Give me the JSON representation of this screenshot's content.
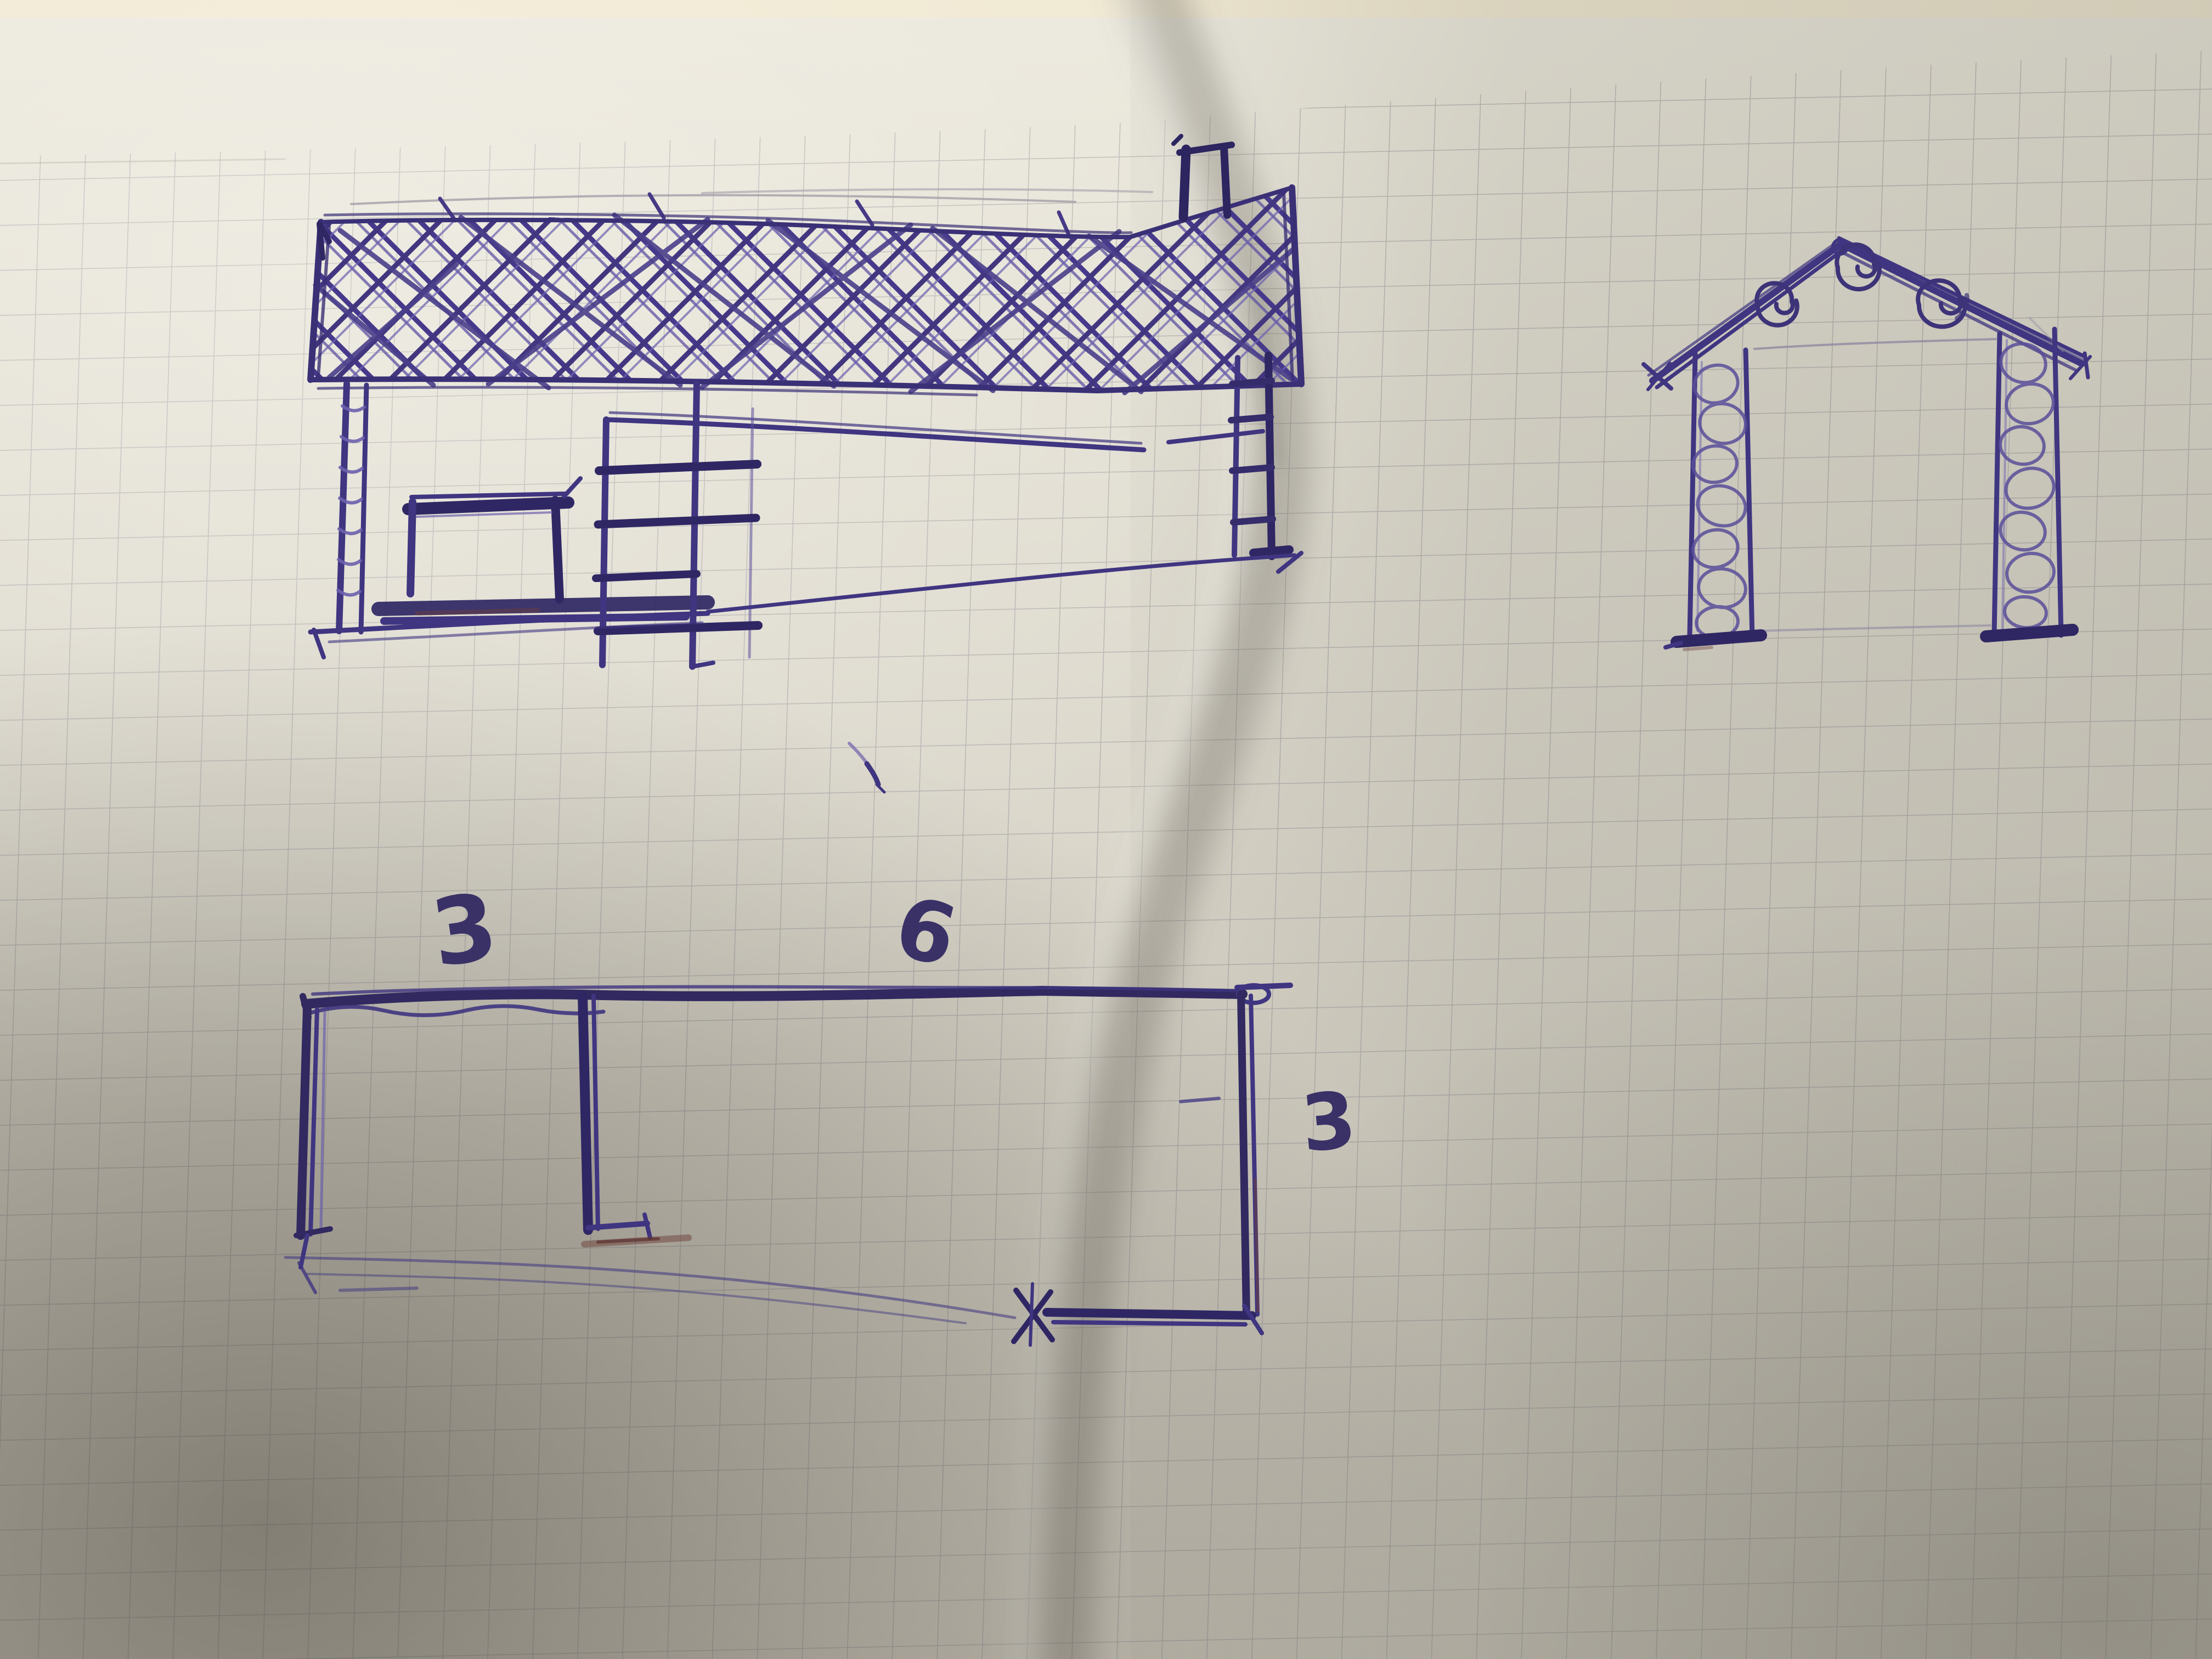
{
  "page": {
    "kind": "photograph of a hand-drawn pen sketch on folded squared (graph) paper",
    "paper": {
      "base_color": "#e7e3d7",
      "grid_color": "#8f8b96",
      "cream_band_color": "#f0e8d1",
      "shadow_color": "#8f8b80"
    },
    "ink": {
      "main": "#3f3580",
      "heavy": "#2f2763",
      "light": "#6c61ad",
      "pencil": "#a19caa",
      "red_accent": "#6e3f39"
    },
    "elements": [
      "house-side-elevation-with-crosshatched-roof-and-chimney",
      "gable-end-view-with-stone-columns-and-spiral-eaves",
      "floor-plan-rectangle-with-dimensions"
    ]
  },
  "floor_plan": {
    "labels": {
      "left_width": "3",
      "top_width": "6",
      "right_height": "3"
    }
  }
}
